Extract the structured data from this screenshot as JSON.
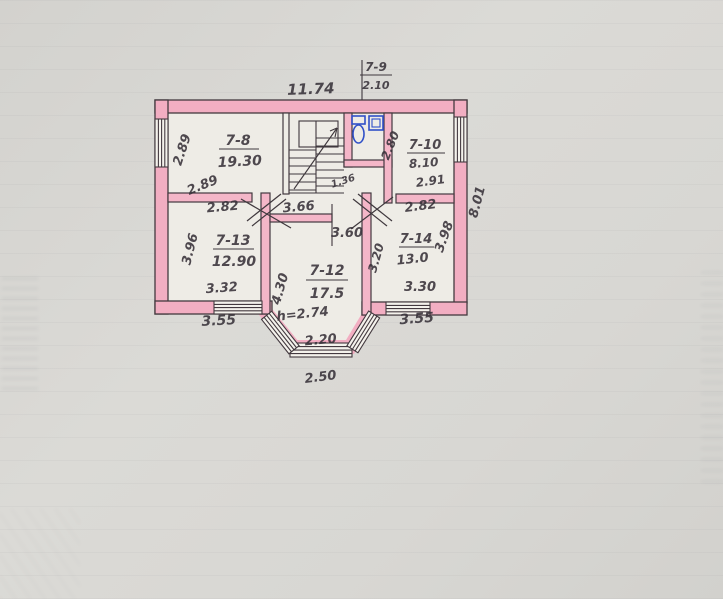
{
  "palette": {
    "paper": "#d8d7d3",
    "room_fill": "#eeece6",
    "wall_pink": "#f2aec2",
    "wall_pink_light": "#f6c6d2",
    "ink": "#3f383d",
    "fixture_blue": "#3050c8"
  },
  "plan": {
    "rooms": [
      {
        "id": "7-8",
        "area": "19.30"
      },
      {
        "id": "7-9",
        "area": "2.10"
      },
      {
        "id": "7-10",
        "area": "8.10"
      },
      {
        "id": "7-12",
        "area": "17.5"
      },
      {
        "id": "7-13",
        "area": "12.90"
      },
      {
        "id": "7-14",
        "area": "13.0"
      }
    ],
    "labels": {
      "top_width": "11.74",
      "wc_id": "7-9",
      "wc_area": "2.10",
      "r78_id": "7-8",
      "r78_area": "19.30",
      "r78_side": "2.89",
      "r78_diag": "2.89",
      "r710_id": "7-10",
      "r710_area": "8.10",
      "r710_width": "2.91",
      "r710_side": "2.80",
      "hall_small": "1.36",
      "hall_width": "3.66",
      "hall_opening": "3.60",
      "r713_top": "2.82",
      "r713_side": "3.96",
      "r713_id": "7-13",
      "r713_area": "12.90",
      "r713_width": "3.32",
      "r713_outer": "3.55",
      "right_side_height": "8.01",
      "r714_top": "2.82",
      "r714_side_left": "3.20",
      "r714_side_right": "3.98",
      "r714_id": "7-14",
      "r714_area": "13.0",
      "r714_width": "3.30",
      "r714_outer": "3.55",
      "r712_side": "4.30",
      "r712_id": "7-12",
      "r712_area": "17.5",
      "r712_height": "h=2.74",
      "r712_width": "2.20",
      "bay_width": "2.50"
    }
  }
}
